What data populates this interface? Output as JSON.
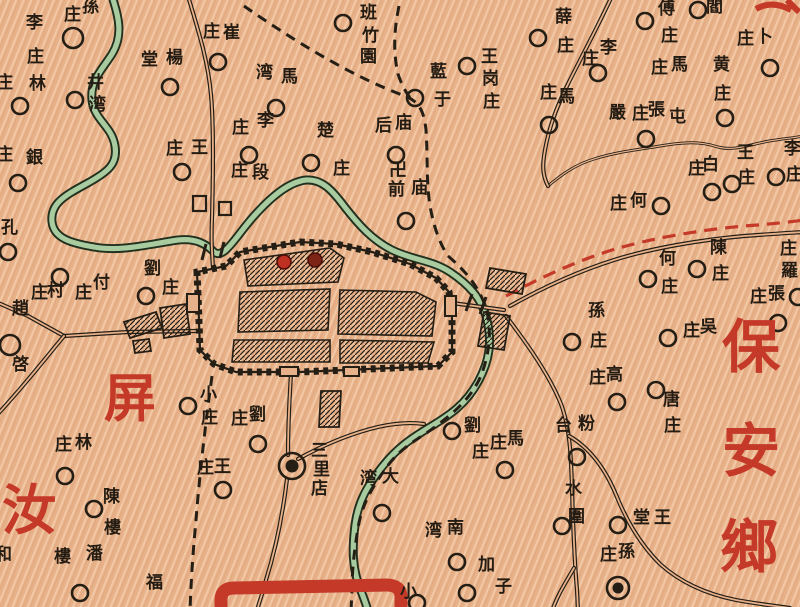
{
  "colors": {
    "paper": "#e7b18a",
    "ink": "#251e15",
    "river_casing": "#22301e",
    "river_fill": "#a8cba0",
    "red": "#c43928",
    "city_red_a": "#bd3022",
    "city_red_b": "#7e2417"
  },
  "region_labels": [
    {
      "text": "屏",
      "x": 104,
      "y": 378,
      "size": 52
    },
    {
      "text": "汝",
      "x": 2,
      "y": 488,
      "size": 54
    },
    {
      "text": "保",
      "x": 722,
      "y": 324,
      "size": 58
    },
    {
      "text": "安",
      "x": 722,
      "y": 428,
      "size": 58
    },
    {
      "text": "鄉",
      "x": 720,
      "y": 524,
      "size": 58
    }
  ],
  "red_fragment_paths": [
    "M756,9 C768,2 780,4 791,10",
    "M787,0 L799,12"
  ],
  "temple": {
    "symbol": "卍",
    "x": 389,
    "y": 163,
    "size": 18
  },
  "villages": [
    {
      "n": "孫庄",
      "c": [
        73,
        38
      ],
      "r": 10,
      "ch": [
        [
          "孫",
          82,
          0
        ],
        [
          "庄",
          64,
          8
        ]
      ]
    },
    {
      "n": "李庄",
      "ch": [
        [
          "李",
          26,
          16
        ],
        [
          "庄",
          27,
          50
        ]
      ]
    },
    {
      "n": "林庄",
      "c": [
        20,
        106
      ],
      "ch": [
        [
          "庄",
          -4,
          76
        ],
        [
          "林",
          29,
          77
        ]
      ]
    },
    {
      "n": "銀庄",
      "c": [
        18,
        183
      ],
      "ch": [
        [
          "庄",
          -4,
          148
        ],
        [
          "銀",
          26,
          151
        ]
      ]
    },
    {
      "n": "孔庄",
      "c": [
        8,
        252
      ],
      "ch": [
        [
          "孔",
          1,
          221
        ]
      ]
    },
    {
      "n": "楊堂",
      "c": [
        170,
        87
      ],
      "ch": [
        [
          "堂",
          141,
          53
        ],
        [
          "楊",
          166,
          51
        ]
      ]
    },
    {
      "n": "井湾",
      "c": [
        75,
        100
      ],
      "ch": [
        [
          "井",
          87,
          76
        ],
        [
          "湾",
          89,
          98
        ]
      ]
    },
    {
      "n": "崔庄",
      "c": [
        218,
        62
      ],
      "ch": [
        [
          "庄",
          203,
          25
        ],
        [
          "崔",
          223,
          26
        ]
      ]
    },
    {
      "n": "馬湾",
      "c": [
        276,
        108
      ],
      "ch": [
        [
          "湾",
          256,
          66
        ],
        [
          "馬",
          281,
          70
        ]
      ]
    },
    {
      "n": "李庄",
      "c": [
        249,
        155
      ],
      "ch": [
        [
          "庄",
          232,
          121
        ],
        [
          "李",
          257,
          114
        ]
      ]
    },
    {
      "n": "段庄",
      "ch": [
        [
          "庄",
          231,
          164
        ],
        [
          "段",
          252,
          166
        ]
      ]
    },
    {
      "n": "王庄",
      "c": [
        182,
        172
      ],
      "ch": [
        [
          "庄",
          166,
          142
        ],
        [
          "王",
          191,
          141
        ]
      ]
    },
    {
      "n": "班竹園",
      "c": [
        343,
        23
      ],
      "ch": [
        [
          "班",
          360,
          6
        ],
        [
          "竹",
          362,
          29
        ],
        [
          "園",
          360,
          50
        ]
      ]
    },
    {
      "n": "藍于",
      "c": [
        415,
        98
      ],
      "ch": [
        [
          "藍",
          430,
          65
        ],
        [
          "于",
          434,
          93
        ]
      ]
    },
    {
      "n": "楚庄",
      "c": [
        311,
        163
      ],
      "ch": [
        [
          "楚",
          317,
          124
        ],
        [
          "庄",
          333,
          162
        ]
      ]
    },
    {
      "n": "庙后",
      "c": [
        396,
        155
      ],
      "ch": [
        [
          "后",
          375,
          119
        ],
        [
          "庙",
          395,
          116
        ]
      ]
    },
    {
      "n": "庙前",
      "c": [
        406,
        221
      ],
      "ch": [
        [
          "前",
          388,
          183
        ],
        [
          "庙",
          411,
          181
        ]
      ]
    },
    {
      "n": "王岗庄",
      "c": [
        467,
        66
      ],
      "ch": [
        [
          "王",
          481,
          50
        ],
        [
          "岗",
          482,
          72
        ],
        [
          "庄",
          483,
          95
        ]
      ]
    },
    {
      "n": "薛庄",
      "c": [
        538,
        38
      ],
      "ch": [
        [
          "薛",
          555,
          10
        ],
        [
          "庄",
          557,
          39
        ]
      ]
    },
    {
      "n": "馬庄",
      "c": [
        549,
        125
      ],
      "ch": [
        [
          "庄",
          540,
          86
        ],
        [
          "馬",
          558,
          90
        ]
      ]
    },
    {
      "n": "李庄",
      "c": [
        598,
        73
      ],
      "ch": [
        [
          "庄",
          582,
          52
        ],
        [
          "李",
          600,
          41
        ]
      ]
    },
    {
      "n": "傅庄",
      "c": [
        645,
        21
      ],
      "ch": [
        [
          "傅",
          658,
          2
        ],
        [
          "庄",
          661,
          29
        ]
      ]
    },
    {
      "n": "閻庄",
      "c": [
        698,
        10
      ],
      "ch": [
        [
          "閻",
          706,
          0
        ]
      ]
    },
    {
      "n": "卜庄",
      "c": [
        770,
        68
      ],
      "ch": [
        [
          "庄",
          737,
          32
        ],
        [
          "卜",
          756,
          30
        ]
      ]
    },
    {
      "n": "馬庄",
      "ch": [
        [
          "庄",
          651,
          61
        ],
        [
          "馬",
          671,
          58
        ]
      ]
    },
    {
      "n": "黄庄",
      "c": [
        725,
        118
      ],
      "ch": [
        [
          "黄",
          713,
          58
        ],
        [
          "庄",
          714,
          87
        ]
      ]
    },
    {
      "n": "嚴庄",
      "c": [
        646,
        139
      ],
      "ch": [
        [
          "嚴",
          609,
          106
        ],
        [
          "庄",
          632,
          107
        ]
      ]
    },
    {
      "n": "張屯",
      "ch": [
        [
          "張",
          648,
          103
        ],
        [
          "屯",
          669,
          110
        ]
      ]
    },
    {
      "n": "何庄",
      "c": [
        661,
        206
      ],
      "ch": [
        [
          "庄",
          610,
          197
        ],
        [
          "何",
          630,
          194
        ]
      ]
    },
    {
      "n": "白庄",
      "c": [
        712,
        192
      ],
      "ch": [
        [
          "庄",
          688,
          162
        ],
        [
          "白",
          702,
          158
        ]
      ]
    },
    {
      "n": "王庄",
      "c": [
        732,
        184
      ],
      "ch": [
        [
          "王",
          737,
          146
        ],
        [
          "庄",
          738,
          171
        ]
      ]
    },
    {
      "n": "李庄",
      "c": [
        776,
        177
      ],
      "ch": [
        [
          "李",
          784,
          142
        ],
        [
          "庄",
          786,
          168
        ]
      ]
    },
    {
      "n": "陳庄",
      "c": [
        697,
        269
      ],
      "ch": [
        [
          "陳",
          710,
          241
        ],
        [
          "庄",
          712,
          267
        ]
      ]
    },
    {
      "n": "何庄",
      "c": [
        648,
        279
      ],
      "ch": [
        [
          "何",
          659,
          252
        ],
        [
          "庄",
          661,
          280
        ]
      ]
    },
    {
      "n": "羅庄",
      "c": [
        798,
        297
      ],
      "ch": [
        [
          "庄",
          780,
          242
        ],
        [
          "羅",
          781,
          264
        ]
      ]
    },
    {
      "n": "張庄",
      "c": [
        778,
        323
      ],
      "ch": [
        [
          "庄",
          750,
          290
        ],
        [
          "張",
          768,
          287
        ]
      ]
    },
    {
      "n": "孫庄",
      "c": [
        572,
        342
      ],
      "ch": [
        [
          "孫",
          588,
          304
        ],
        [
          "庄",
          590,
          334
        ]
      ]
    },
    {
      "n": "吳庄",
      "c": [
        668,
        338
      ],
      "ch": [
        [
          "庄",
          683,
          324
        ],
        [
          "吳",
          700,
          320
        ]
      ]
    },
    {
      "n": "高庄",
      "c": [
        617,
        402
      ],
      "ch": [
        [
          "庄",
          589,
          371
        ],
        [
          "高",
          606,
          368
        ]
      ]
    },
    {
      "n": "唐庄",
      "c": [
        656,
        390
      ],
      "ch": [
        [
          "唐",
          663,
          393
        ],
        [
          "庄",
          664,
          419
        ]
      ]
    },
    {
      "n": "付庄",
      "c": [
        60,
        277
      ],
      "ch": [
        [
          "庄",
          75,
          286
        ],
        [
          "付",
          93,
          276
        ]
      ]
    },
    {
      "n": "村庄",
      "ch": [
        [
          "庄",
          31,
          286
        ],
        [
          "村",
          47,
          284
        ]
      ]
    },
    {
      "n": "劉庄",
      "c": [
        146,
        296
      ],
      "ch": [
        [
          "劉",
          144,
          262
        ],
        [
          "庄",
          162,
          281
        ]
      ]
    },
    {
      "n": "趙啓",
      "c": [
        10,
        345
      ],
      "r": 10,
      "ch": [
        [
          "趙",
          12,
          302
        ],
        [
          "啓",
          12,
          358
        ]
      ]
    },
    {
      "n": "小庄",
      "c": [
        188,
        406
      ],
      "ch": [
        [
          "小",
          200,
          388
        ],
        [
          "庄",
          201,
          411
        ]
      ]
    },
    {
      "n": "劉庄",
      "c": [
        258,
        444
      ],
      "ch": [
        [
          "庄",
          231,
          412
        ],
        [
          "劉",
          249,
          408
        ]
      ]
    },
    {
      "n": "王庄",
      "c": [
        223,
        490
      ],
      "ch": [
        [
          "庄",
          197,
          461
        ],
        [
          "王",
          214,
          460
        ]
      ]
    },
    {
      "n": "劉庄",
      "c": [
        452,
        431
      ],
      "ch": [
        [
          "劉",
          464,
          419
        ],
        [
          "庄",
          472,
          445
        ]
      ]
    },
    {
      "n": "馬庄",
      "c": [
        505,
        470
      ],
      "ch": [
        [
          "庄",
          490,
          436
        ],
        [
          "馬",
          507,
          432
        ]
      ]
    },
    {
      "n": "大湾",
      "c": [
        382,
        513
      ],
      "ch": [
        [
          "湾",
          360,
          472
        ],
        [
          "大",
          382,
          470
        ]
      ]
    },
    {
      "n": "南湾",
      "c": [
        457,
        562
      ],
      "ch": [
        [
          "湾",
          425,
          524
        ],
        [
          "南",
          447,
          521
        ]
      ]
    },
    {
      "n": "加子",
      "c": [
        467,
        593
      ],
      "ch": [
        [
          "加",
          478,
          558
        ],
        [
          "子",
          495,
          580
        ]
      ]
    },
    {
      "n": "小",
      "c": [
        417,
        603
      ],
      "ch": [
        [
          "小",
          400,
          585
        ]
      ]
    },
    {
      "n": "粉台",
      "c": [
        577,
        457
      ],
      "ch": [
        [
          "台",
          555,
          419
        ],
        [
          "粉",
          578,
          417
        ]
      ]
    },
    {
      "n": "水圍",
      "c": [
        562,
        526
      ],
      "ch": [
        [
          "水",
          565,
          482
        ],
        [
          "圍",
          568,
          510
        ]
      ]
    },
    {
      "n": "王堂",
      "c": [
        618,
        525
      ],
      "ch": [
        [
          "堂",
          633,
          511
        ],
        [
          "王",
          654,
          511
        ]
      ]
    },
    {
      "n": "孫庄",
      "ch": [
        [
          "庄",
          600,
          548
        ],
        [
          "孫",
          618,
          545
        ]
      ]
    },
    {
      "n": "陳樓",
      "c": [
        94,
        509
      ],
      "ch": [
        [
          "陳",
          103,
          490
        ],
        [
          "樓",
          104,
          521
        ]
      ]
    },
    {
      "n": "潘樓",
      "c": [
        80,
        593
      ],
      "ch": [
        [
          "樓",
          54,
          550
        ],
        [
          "潘",
          86,
          547
        ]
      ]
    },
    {
      "n": "福",
      "ch": [
        [
          "福",
          146,
          576
        ]
      ]
    },
    {
      "n": "林庄",
      "c": [
        65,
        476
      ],
      "ch": [
        [
          "庄",
          55,
          438
        ],
        [
          "林",
          75,
          436
        ]
      ]
    },
    {
      "n": "和",
      "ch": [
        [
          "和",
          -5,
          548
        ]
      ]
    }
  ],
  "towns": [
    {
      "n": "三里店",
      "c": [
        292,
        466
      ],
      "ro": 13,
      "ri": 6.5,
      "ch": [
        [
          "三",
          311,
          444
        ],
        [
          "里",
          313,
          463
        ],
        [
          "店",
          311,
          482
        ]
      ]
    },
    {
      "n": "孫庄鎮",
      "c": [
        618,
        588
      ],
      "ro": 11,
      "ri": 5.5,
      "ch": []
    }
  ],
  "features": {
    "rivers": [
      "M112,-4 C118,16 124,34 112,54 C102,70 90,80 92,100 C94,120 112,126 115,146 C118,164 108,172 86,184 C64,196 50,204 52,222 C54,238 70,243 94,247 C120,252 150,244 178,240 C196,238 206,244 214,252 C224,260 236,236 254,216 C270,198 288,182 306,180 C322,179 332,190 344,206 C358,224 372,240 392,250 C412,260 432,260 450,272 C468,284 482,298 487,320 C492,342 490,360 478,382 C466,404 450,415 430,427 C410,439 396,449 382,467 C368,485 358,501 355,525 C352,549 352,569 361,591 C365,601 366,604 368,611"
    ],
    "streams": [
      "M548,186 C560,176 574,165 594,159 C616,152 636,150 660,146 C684,142 700,141 718,147 C736,152 756,142 776,140 C788,138 794,138 803,136"
    ],
    "roads": [
      "M188,-4 C198,30 208,60 211,95 C214,128 213,180 212,218 C211,240 212,252 213,268",
      "M196,331 L128,332 L64,336",
      "M64,336 L28,316 L-4,302",
      "M64,336 C44,360 24,386 -4,416",
      "M291,374 C289,406 288,436 288,455",
      "M287,479 C283,512 276,548 266,580 C262,596 259,602 257,611",
      "M298,459 C318,448 348,434 378,427 C396,423 410,422 424,424",
      "M506,316 C524,340 548,372 561,404 C570,428 571,456 572,488 C573,524 574,556 577,590 L578,611",
      "M569,436 C590,448 606,470 617,497 C628,524 642,546 660,564 C680,582 706,594 736,600 C758,604 776,606 790,608",
      "M574,568 C566,582 558,594 552,611",
      "M510,306 C542,288 576,272 614,260 C652,248 700,240 744,236 C770,234 788,233 804,232",
      "M612,-4 C600,22 584,52 568,84 C556,108 548,130 544,156 C542,170 544,178 548,186",
      "M452,303 L504,310"
    ],
    "boundaries": [
      "M244,6 C290,38 350,76 405,96 C420,102 424,112 426,130 C428,160 426,180 430,206 C434,228 440,244 448,256",
      "M399,6 C394,30 393,52 398,74 C402,86 406,92 410,98",
      "M448,256 C462,268 478,284 486,308 C492,330 490,356 479,380 C468,402 450,416 428,432 C406,446 396,454 386,468 C372,488 362,504 358,528 C354,552 352,572 352,590 L351,611",
      "M212,376 C206,420 200,470 196,520 C193,552 191,580 190,611"
    ],
    "red_boundary": "M506,296 C540,278 574,262 612,250 C652,238 700,230 744,226 C772,224 790,222 804,220",
    "city": {
      "wall": "M198,295 L197,272 L226,266 L240,252 L300,242 L336,244 L372,252 L410,264 L436,278 L449,292 L452,316 L452,352 L438,366 L300,372 L236,372 L214,364 L200,350 Z",
      "gates": [
        [
          187,
          294,
          12,
          18
        ],
        [
          280,
          367,
          18,
          9
        ],
        [
          344,
          367,
          15,
          9
        ],
        [
          445,
          296,
          11,
          20
        ]
      ],
      "blocks": [
        "M244,260 L330,248 L344,258 L338,282 L248,286 Z",
        "M240,292 L330,289 L328,330 L238,332 Z",
        "M340,290 L416,292 L436,302 L432,336 L338,334 Z",
        "M234,340 L330,340 L330,362 L232,362 Z",
        "M340,340 L434,342 L428,363 L340,363 Z"
      ],
      "red_markers": [
        {
          "c": [
            284,
            262
          ],
          "r": 7,
          "k": "a"
        },
        {
          "c": [
            315,
            260
          ],
          "r": 7,
          "k": "b"
        }
      ]
    },
    "suburbs": [
      "M124,322 L156,312 L162,328 L130,338 Z",
      "M160,308 L186,304 L190,334 L164,338 Z",
      "M133,341 L149,339 L151,351 L135,353 Z",
      "M490,268 L526,274 L522,294 L486,288 Z",
      "M484,312 L510,316 L504,350 L478,346 Z",
      "M321,391 L341,391 L339,427 L319,427 Z"
    ],
    "buildings": [
      [
        193,
        196,
        13,
        15
      ],
      [
        219,
        202,
        12,
        13
      ]
    ],
    "bridge_ticks": [
      "M206,244 L202,260",
      "M224,242 L220,258",
      "M472,294 L466,311",
      "M486,297 L480,314"
    ],
    "red_arc": "M221,611 L221,600 Q221,588 234,588 L386,585 Q401,585 401,597 L401,611"
  }
}
